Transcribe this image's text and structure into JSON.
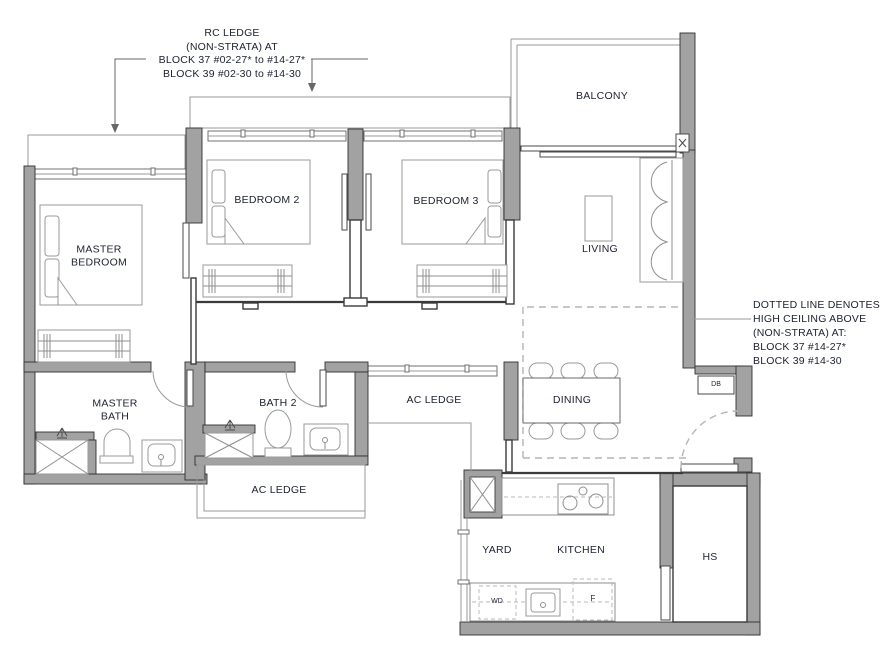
{
  "annotations": {
    "rc_ledge": {
      "line1": "RC LEDGE",
      "line2": "(NON-STRATA) AT",
      "line3": "BLOCK 37 #02-27* to #14-27*",
      "line4": "BLOCK 39  #02-30  to #14-30"
    },
    "high_ceiling": {
      "line1": "DOTTED LINE DENOTES",
      "line2": "HIGH CEILING ABOVE",
      "line3": "(NON-STRATA) AT:",
      "line4": "BLOCK 37 #14-27*",
      "line5": "BLOCK 39 #14-30"
    }
  },
  "rooms": {
    "master_bedroom": "MASTER\nBEDROOM",
    "bedroom_2": "BEDROOM 2",
    "bedroom_3": "BEDROOM 3",
    "balcony": "BALCONY",
    "living": "LIVING",
    "dining": "DINING",
    "master_bath": "MASTER\nBATH",
    "bath_2": "BATH 2",
    "ac_ledge_right": "AC LEDGE",
    "ac_ledge_bottom": "AC LEDGE",
    "yard": "YARD",
    "kitchen": "KITCHEN",
    "hs": "HS"
  },
  "markers": {
    "db": "DB",
    "wd": "WD",
    "fridge": "F"
  },
  "colors": {
    "wall": "#a2a2a2",
    "wall_outline": "#303030",
    "thin_line": "#9a9a9a",
    "dashed_line": "#b5b5b5",
    "text": "#1c2130",
    "background": "#ffffff"
  }
}
